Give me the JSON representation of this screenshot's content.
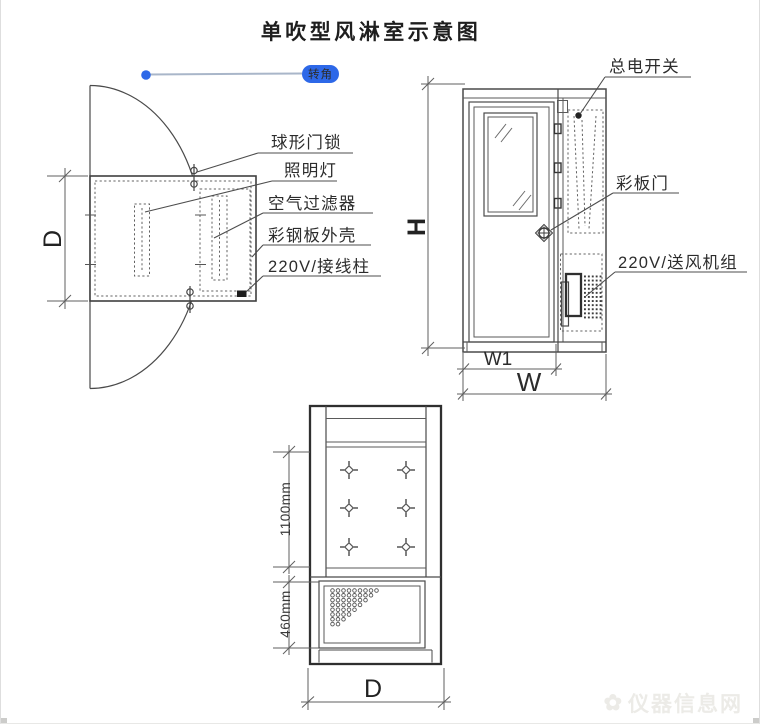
{
  "title": "单吹型风淋室示意图",
  "annotation": {
    "label": "转角"
  },
  "plan_view": {
    "callouts": {
      "door_lock": "球形门锁",
      "lamp": "照明灯",
      "air_filter": "空气过滤器",
      "steel_shell": "彩钢板外壳",
      "terminal": "220V/接线柱"
    },
    "dims": {
      "depth": "D"
    }
  },
  "front_view": {
    "callouts": {
      "main_switch": "总电开关",
      "panel_door": "彩板门",
      "fan_unit": "220V/送风机组"
    },
    "dims": {
      "height": "H",
      "door_width": "W1",
      "width": "W"
    }
  },
  "side_view": {
    "dims": {
      "nozzle_section": "1100mm",
      "fan_section": "460mm",
      "depth": "D"
    }
  },
  "watermark": {
    "text": "仪器信息网",
    "logo": "✿"
  },
  "colors": {
    "accent_blue": "#2d68e8",
    "line": "#4a4a4a"
  }
}
